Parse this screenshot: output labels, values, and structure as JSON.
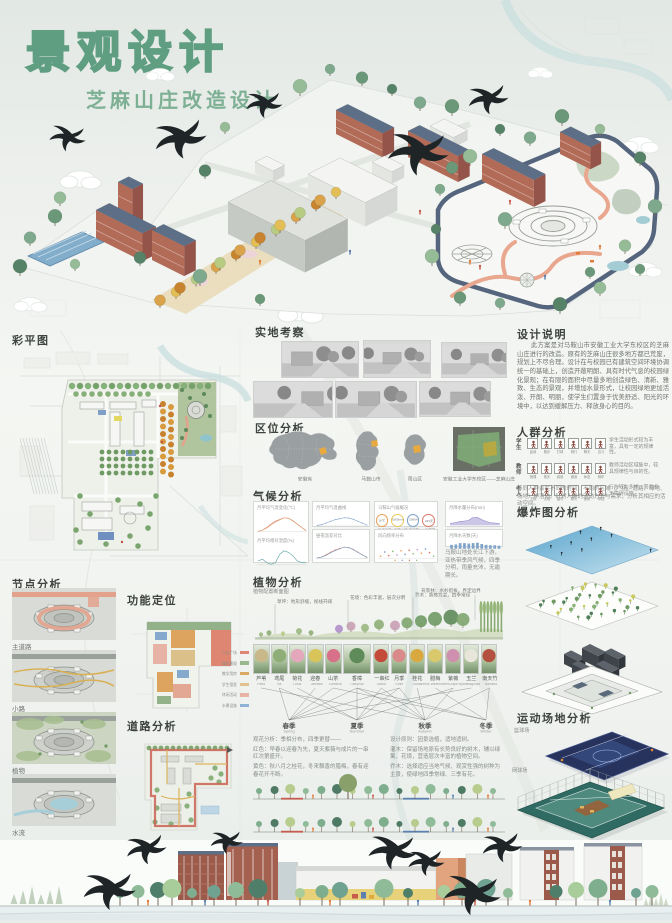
{
  "poster": {
    "title": "景观设计",
    "subtitle": "芝麻山庄改造设计",
    "accent_green": "#5f9e81"
  },
  "sections": {
    "master_plan": {
      "heading": "彩平图"
    },
    "survey": {
      "heading": "实地考察"
    },
    "location": {
      "heading": "区位分析",
      "map_labels": [
        "安徽省",
        "马鞍山市",
        "雨山区"
      ],
      "satellite_caption": "安徽工业大学东校区——芝麻山庄"
    },
    "climate": {
      "heading": "气候分析",
      "cards": {
        "temp_title": "月平均气温变化(℃)",
        "humid_title": "月平均相对湿度(%)",
        "line_title": "月平均气温曲线",
        "range_title": "昼夜温差对比",
        "stats_title": "马鞍山气候概况",
        "wind_title": "风向频率分布",
        "area_title": "月降水量分布(mm)",
        "bar_title": "月降水天数(天)"
      },
      "stats": [
        {
          "value": "16℃",
          "label": "年均气温"
        },
        {
          "value": "1060mm",
          "label": "年降水量"
        },
        {
          "value": "2006h",
          "label": "年日照"
        },
        {
          "value": "233天",
          "label": "无霜期"
        }
      ],
      "chart_values": {
        "temp_high": [
          8,
          10,
          15,
          21,
          26,
          29,
          32,
          31,
          27,
          21,
          15,
          9
        ],
        "temp_low": [
          0,
          2,
          6,
          12,
          17,
          21,
          25,
          24,
          19,
          13,
          7,
          2
        ],
        "humidity": [
          74,
          75,
          73,
          72,
          73,
          78,
          80,
          79,
          77,
          74,
          73,
          73
        ],
        "rain_area": [
          42,
          58,
          82,
          95,
          108,
          172,
          182,
          128,
          86,
          56,
          52,
          34
        ],
        "rain_bars": [
          9,
          10,
          13,
          13,
          12,
          13,
          14,
          11,
          9,
          8,
          8,
          7
        ]
      },
      "note": "马鞍山地处长江下游，亚热带季风气候，四季分明，雨量充沛，无霜期长。"
    },
    "plants": {
      "heading": "植物分析",
      "section_label": "植物配置断面图",
      "annotations": [
        "草坪：地形舒缓，视线开阔",
        "花境：色彩丰富，层次分明",
        "乔木：香樟为主，四季常绿",
        "背景林：水杉挺拔，界定边界"
      ],
      "items": [
        {
          "name": "芦苇",
          "en": "Reed",
          "color": "#c9b98a"
        },
        {
          "name": "鸢尾",
          "en": "Iris",
          "color": "#8fae77"
        },
        {
          "name": "荷花",
          "en": "Lotus",
          "color": "#e4a7bc"
        },
        {
          "name": "迎春",
          "en": "Jasmine",
          "color": "#d9c45a"
        },
        {
          "name": "山茶",
          "en": "Camellia",
          "color": "#d9708a"
        },
        {
          "name": "香樟",
          "en": "Camphor",
          "color": "#5f8a5a"
        },
        {
          "name": "一串红",
          "en": "Salvia",
          "color": "#c44a3a"
        },
        {
          "name": "月季",
          "en": "Rose",
          "color": "#d98a8a"
        },
        {
          "name": "桂花",
          "en": "Osmanthus",
          "color": "#d9a93f"
        },
        {
          "name": "腊梅",
          "en": "Wintersweet",
          "color": "#d9c96a"
        },
        {
          "name": "紫薇",
          "en": "Crape Myrtle",
          "color": "#cf8fae"
        },
        {
          "name": "玉兰",
          "en": "Magnolia",
          "color": "#e8e6da"
        },
        {
          "name": "南天竹",
          "en": "Nandina",
          "color": "#b4503f"
        }
      ],
      "plant_seasons": [
        [
          2
        ],
        [
          0,
          1
        ],
        [
          1
        ],
        [
          0
        ],
        [
          0,
          3
        ],
        [
          0,
          1,
          2,
          3
        ],
        [
          1,
          2
        ],
        [
          0,
          1,
          2
        ],
        [
          2
        ],
        [
          3
        ],
        [
          1,
          2
        ],
        [
          0
        ],
        [
          2,
          3
        ]
      ],
      "seasons": [
        {
          "name": "春季",
          "en": "Spring"
        },
        {
          "name": "夏季",
          "en": "Summer"
        },
        {
          "name": "秋季",
          "en": "Autumn"
        },
        {
          "name": "冬季",
          "en": "Winter"
        }
      ],
      "notes_left": [
        "观花分析：季相分布，四季更替——",
        "红色：早春以迎春为先，夏天紫薇与成片的一串红次第盛开。",
        "黄色：秋八月之桂花，冬来飘香的腊梅，春有迎春花开不断。"
      ],
      "notes_right": [
        "设计原则：因景选植，适地适树。",
        "灌木：保留场地原有长势良好的树木，辅以绿篱、花境，营造层次丰富的植物空间。",
        "乔木：选择适应当地气候、观赏性强的树种为主景，使绿地四季常绿、三季有花。"
      ]
    },
    "nodes": {
      "heading": "节点分析",
      "items": [
        {
          "label": "主道路"
        },
        {
          "label": "小路"
        },
        {
          "label": "植物"
        },
        {
          "label": "水流"
        }
      ]
    },
    "function": {
      "heading": "功能定位",
      "legend": [
        {
          "label": "入口广场",
          "color": "#de8672"
        },
        {
          "label": "绿化景观",
          "color": "#9ab88d"
        },
        {
          "label": "教学用房",
          "color": "#d9a963"
        },
        {
          "label": "学生宿舍",
          "color": "#e2c08f"
        },
        {
          "label": "休闲活动",
          "color": "#e6b3a4"
        },
        {
          "label": "水景设施",
          "color": "#8fb3d6"
        }
      ]
    },
    "roads": {
      "heading": "道路分析"
    },
    "description": {
      "heading": "设计说明",
      "text": "此方案是对马鞍山市安徽工业大学东校区的芝麻山庄进行的改造。原有的芝麻山庄很多地方都已荒废，规划上不尽合理。设计在与校园已有建筑空间环境协调统一的基础上，创造开敞明朗、具有时代气息的校园绿化景观；在有限的面积中尽量多地创造绿色、清新、雅致、生态的景观，并增加水景形式，让校园绿地更加活泼、开朗、明丽，使学生们置身于优美舒适、阳光的环境中，以达到缓解压力、释放身心的目的。"
    },
    "crowd": {
      "heading": "人群分析",
      "rows": [
        {
          "label": "学生",
          "activities": [
            "晨读",
            "跑步",
            "打球",
            "骑行",
            "聊天",
            "自习"
          ],
          "note": "学生活动形式较为丰富，具有一定的规律性。"
        },
        {
          "label": "教师",
          "activities": [
            "授课",
            "散步",
            "阅读",
            "健身",
            "休息",
            "骑车"
          ],
          "note": "教师活动区域集中，较具规律性与目的性。"
        },
        {
          "label": "老人",
          "activities": [
            "下棋",
            "太极",
            "遛弯",
            "聊天",
            "健身",
            "带娃"
          ],
          "note": "行为较为多样，需考虑无障碍设施。"
        }
      ],
      "note": "不同人群会在不同的时间、不同的区域（广场、道路、绿地、场地）中活动。针对人群的活动方式与需求，分析其相应的活动空间。"
    },
    "exploded": {
      "heading": "爆炸图分析"
    },
    "sports": {
      "heading": "运动场地分析",
      "courts": [
        {
          "label": "篮球场"
        },
        {
          "label": "网球场"
        }
      ]
    }
  }
}
